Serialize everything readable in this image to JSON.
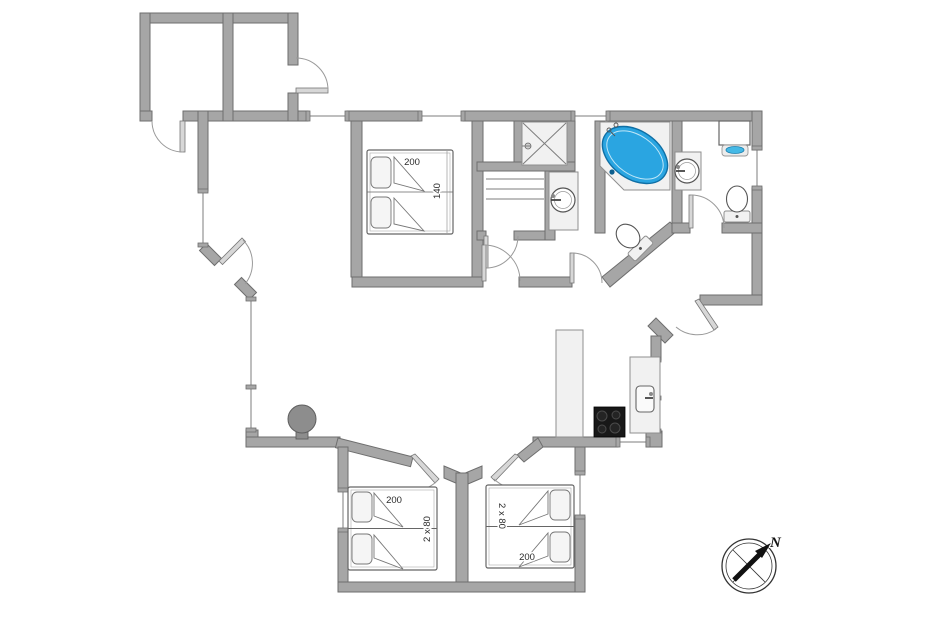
{
  "plan": {
    "type": "floor-plan",
    "labels": {
      "main_bed_length": "200",
      "main_bed_width": "140",
      "left_room_bed_length": "200",
      "left_room_bed_size": "2 x 80",
      "right_room_bed_size": "2 x 80",
      "right_room_bed_length": "200",
      "compass_north": "N"
    },
    "colors": {
      "wall_fill": "#a6a6a6",
      "wall_stroke": "#6e6e6e",
      "fixture_fill": "#f1f1f1",
      "jacuzzi_blue": "#2aa5e1",
      "jacuzzi_stroke": "#0f6fa5",
      "heater_lens_blue": "#45b9e6",
      "cooktop_black": "#181818",
      "stove_gray": "#8d8d8d",
      "background": "#ffffff"
    },
    "fixtures": [
      "double-bed",
      "twin-beds",
      "twin-beds",
      "shower",
      "sauna-benches",
      "washbasin",
      "washbasin",
      "corner-jacuzzi",
      "toilet",
      "toilet",
      "water-heater",
      "wood-stove",
      "kitchen-counter",
      "kitchen-sink",
      "cooktop",
      "compass-rose"
    ]
  }
}
